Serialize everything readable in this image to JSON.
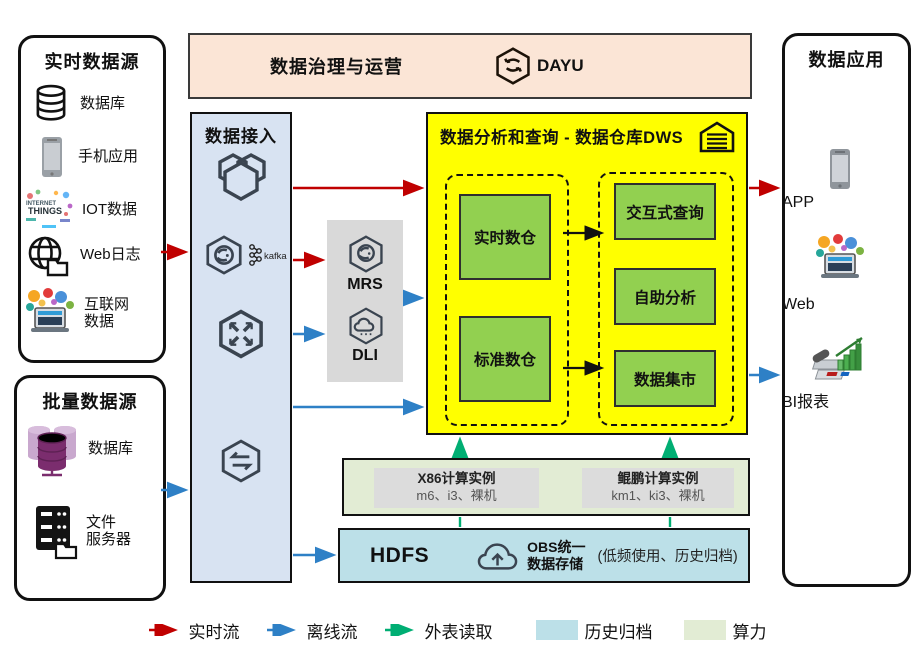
{
  "realtime_sources": {
    "title": "实时数据源",
    "items": [
      {
        "label": "数据库"
      },
      {
        "label": "手机应用"
      },
      {
        "label": "IOT数据"
      },
      {
        "label": "Web日志"
      },
      {
        "label": "互联网\n数据"
      }
    ]
  },
  "batch_sources": {
    "title": "批量数据源",
    "items": [
      {
        "label": "数据库"
      },
      {
        "label": "文件\n服务器"
      }
    ]
  },
  "governance": {
    "title": "数据治理与运营",
    "product": "DAYU"
  },
  "ingestion": {
    "title": "数据接入",
    "services": [
      {
        "name": "DRS"
      },
      {
        "name": "Kafka",
        "logo": "kafka"
      },
      {
        "name": "DIS"
      },
      {
        "name": "CDM"
      }
    ]
  },
  "processing": {
    "services": [
      {
        "name": "MRS"
      },
      {
        "name": "DLI"
      }
    ]
  },
  "dws": {
    "title": "数据分析和查询 - 数据仓库DWS",
    "warehouses": [
      {
        "label": "实时数仓"
      },
      {
        "label": "标准数仓"
      }
    ],
    "analytics": [
      {
        "label": "交互式查询"
      },
      {
        "label": "自助分析"
      },
      {
        "label": "数据集市"
      }
    ]
  },
  "compute": {
    "instances": [
      {
        "title": "X86计算实例",
        "detail": "m6、i3、裸机"
      },
      {
        "title": "鲲鹏计算实例",
        "detail": "km1、ki3、裸机"
      }
    ]
  },
  "storage": {
    "hdfs": "HDFS",
    "obs": "OBS统一\n数据存储",
    "note": "(低频使用、历史归档)"
  },
  "applications": {
    "title": "数据应用",
    "items": [
      {
        "label": "APP"
      },
      {
        "label": "Web"
      },
      {
        "label": "BI报表"
      }
    ]
  },
  "legend": {
    "items": [
      {
        "label": "实时流",
        "type": "arrow",
        "color": "#C00000"
      },
      {
        "label": "离线流",
        "type": "arrow",
        "color": "#2E80C6"
      },
      {
        "label": "外表读取",
        "type": "arrow",
        "color": "#00AE73"
      },
      {
        "label": "历史归档",
        "type": "swatch",
        "color": "#BCE0E8"
      },
      {
        "label": "算力",
        "type": "swatch",
        "color": "#E2ECD4"
      }
    ]
  },
  "icons": {
    "iot_text": "THINGS"
  },
  "colors": {
    "dws_yellow": "#FFFF00",
    "green_box": "#92D050",
    "governance_peach": "#FBE5D6",
    "ingest_blue": "#D8E3F2",
    "process_gray": "#D9D9D9",
    "realtime_flow": "#C00000",
    "offline_flow": "#2E80C6",
    "external_read": "#00AE73"
  }
}
